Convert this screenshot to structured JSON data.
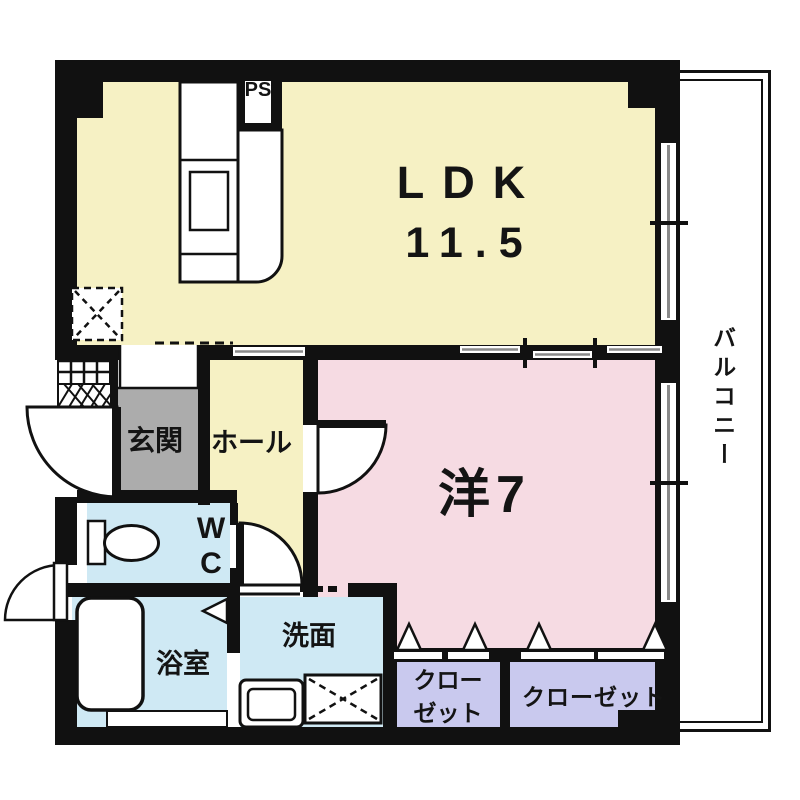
{
  "title": "apartment-floorplan",
  "rooms": {
    "ldk": {
      "label": "LDK",
      "size": "11.5"
    },
    "western_room": {
      "label": "洋7"
    },
    "entrance": {
      "label": "玄関"
    },
    "hall": {
      "label": "ホール"
    },
    "toilet": {
      "label": "WC"
    },
    "bathroom": {
      "label": "浴室"
    },
    "washroom": {
      "label": "洗面"
    },
    "closet_small": {
      "label": "クローゼット"
    },
    "closet_large": {
      "label": "クローゼット"
    },
    "balcony": {
      "label": "バルコニー"
    },
    "pipe_shaft": {
      "label": "PS"
    }
  },
  "colors": {
    "ldk_fill": "#F6F1C4",
    "western_fill": "#F6DBE3",
    "wet_area_fill": "#CFE9F4",
    "closet_fill": "#C9C9EE",
    "entrance_fill": "#ACACAC",
    "wall": "#111111",
    "background": "#FFFFFF"
  }
}
